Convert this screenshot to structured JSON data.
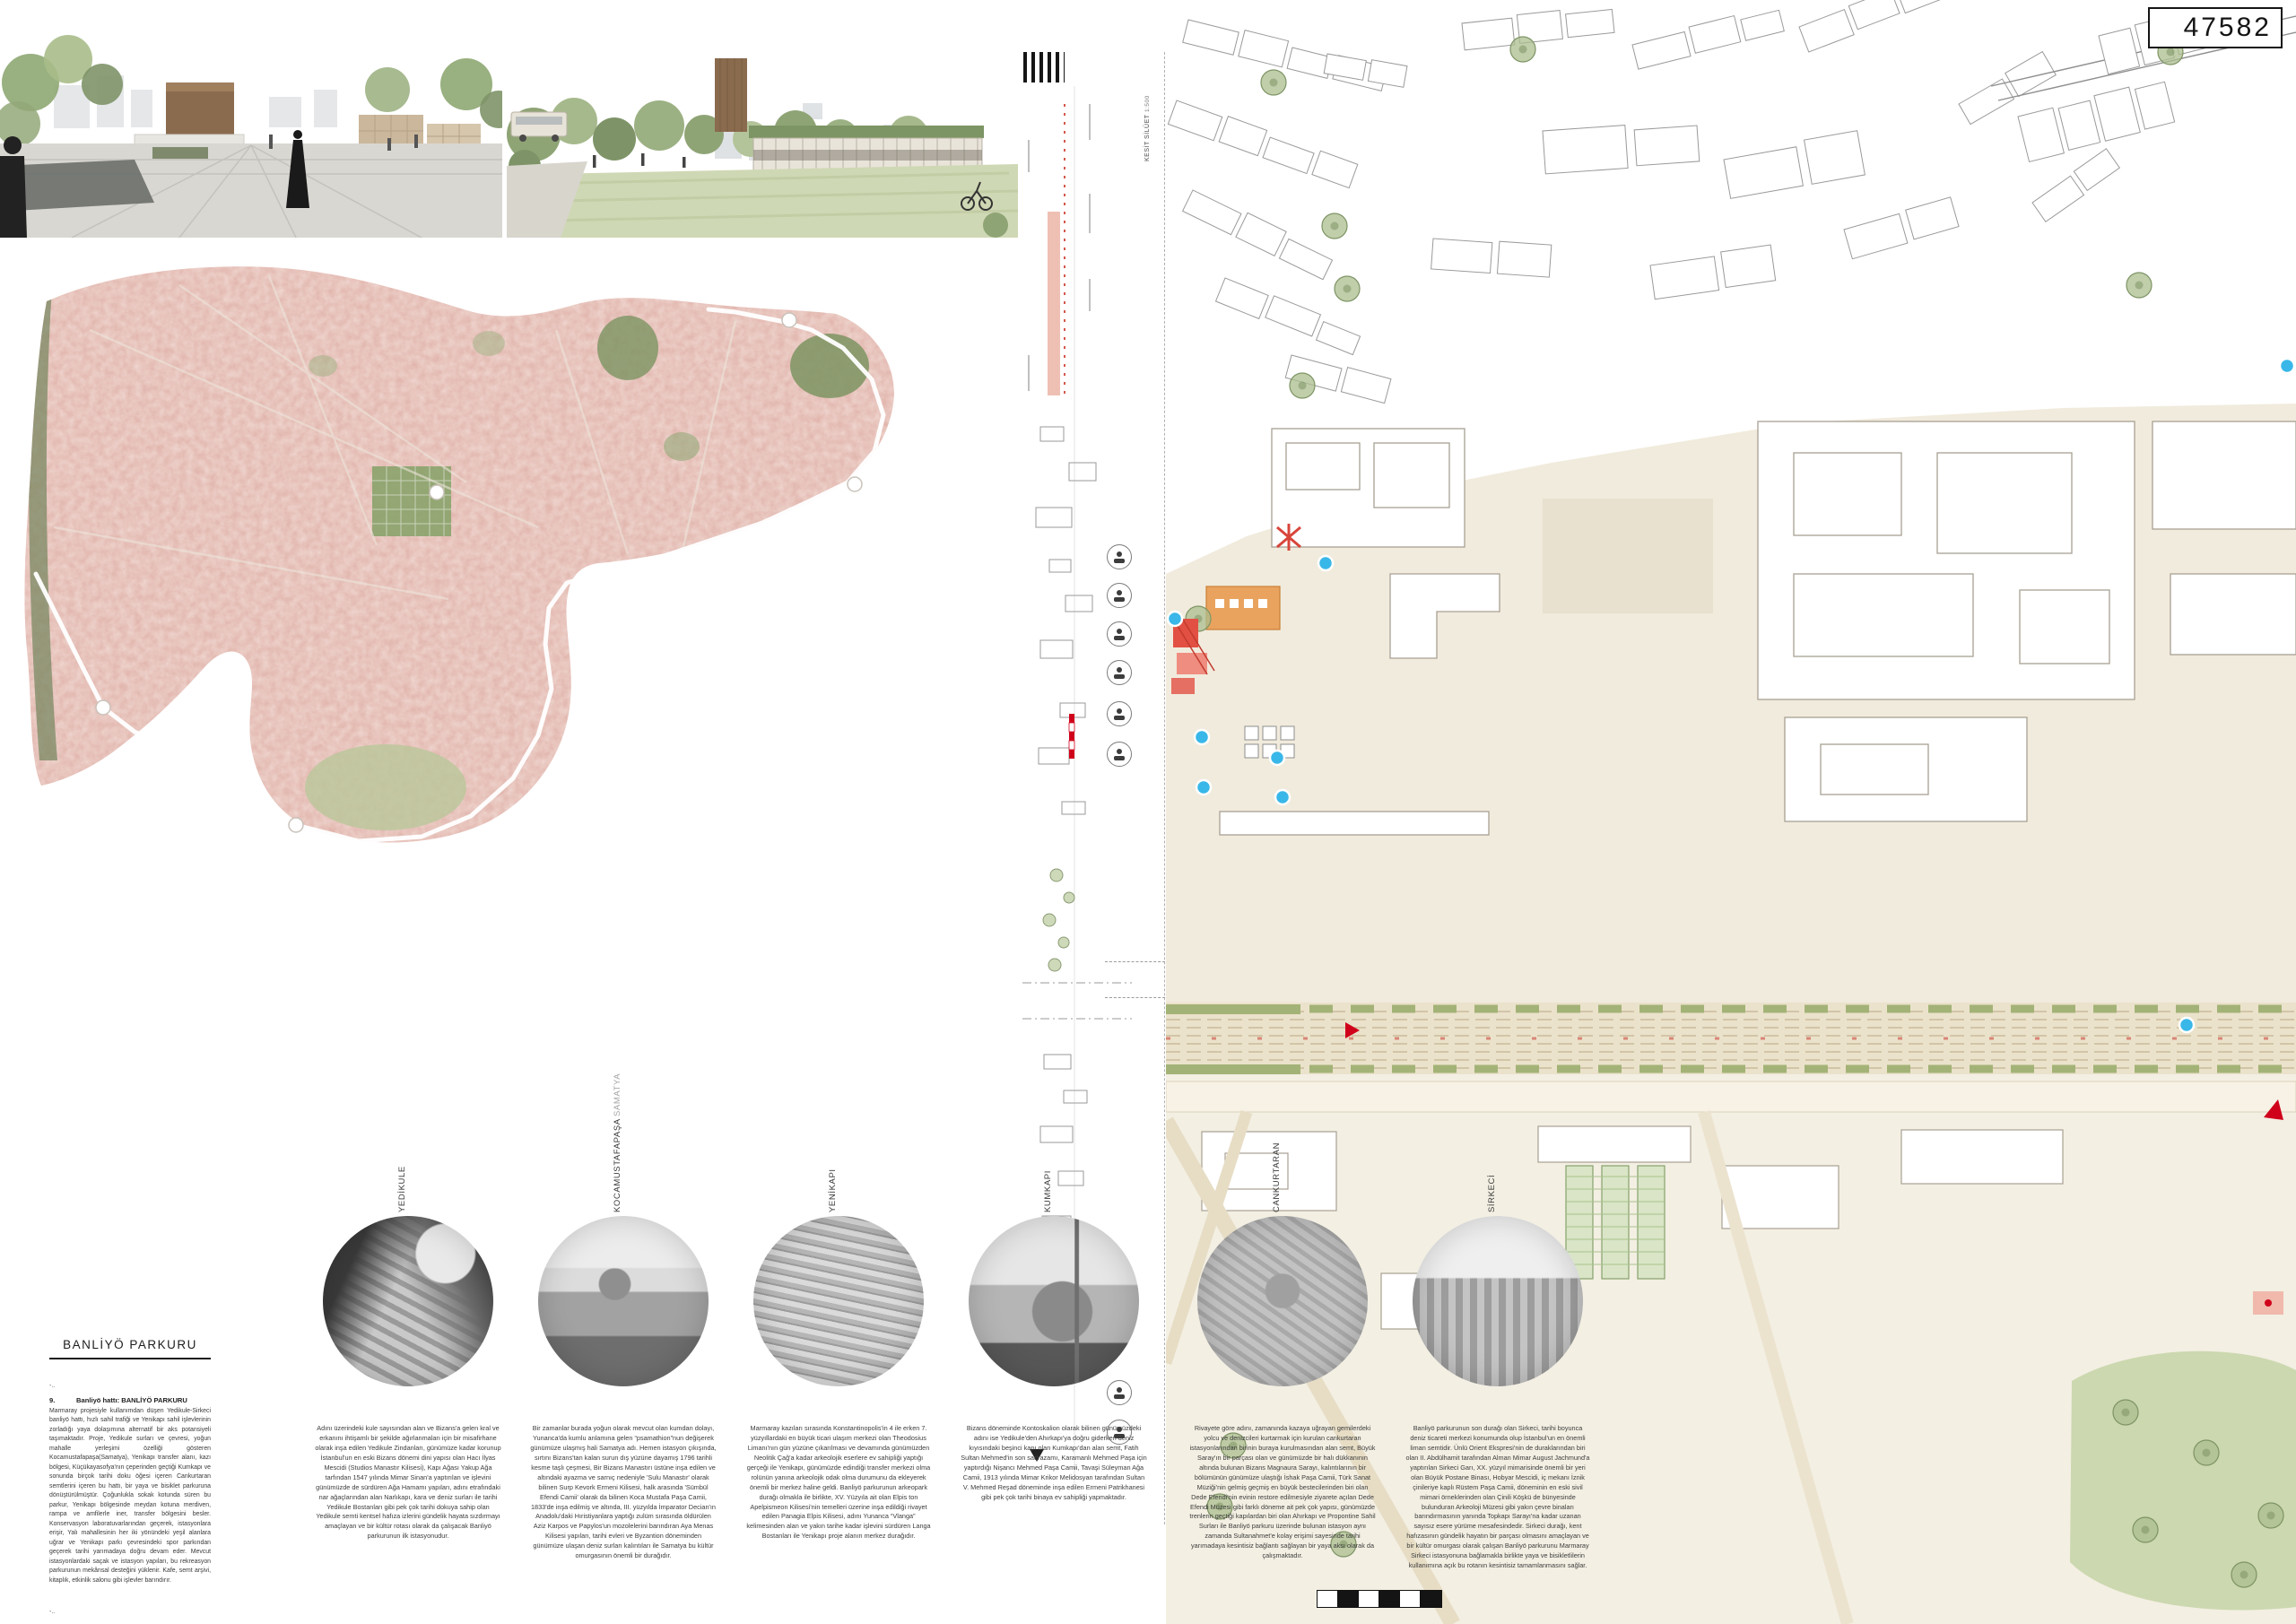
{
  "board": {
    "competition_number": "47582"
  },
  "section_strip": {
    "label": "KESİT SİLÜET",
    "scale": "1:500"
  },
  "title_block": {
    "title": "BANLİYÖ PARKURU",
    "ellipsis_top": "-..",
    "item_number": "9.",
    "heading": "Banliyö hattı: BANLİYÖ PARKURU",
    "body": "Marmaray projesiyle kullanımdan düşen Yedikule-Sirkeci banliyö hattı, hızlı sahil trafiği ve Yenikapı sahil işlevlerinin zorladığı yaya dolaşımına alternatif bir aks potansiyeli taşımaktadır. Proje, Yedikule surları ve çevresi, yoğun mahalle yerleşimi özelliği gösteren Kocamustafapaşa(Samatya), Yenikapı transfer alanı, kazı bölgesi, Küçükayasofya'nın çeperinden geçtiği Kumkapı ve sonunda birçok tarihi doku öğesi içeren Cankurtaran semtlerini içeren bu hattı, bir yaya ve bisiklet parkuruna dönüştürülmüştür. Çoğunlukla sokak kotunda süren bu parkur, Yenikapı bölgesinde meydan kotuna merdiven, rampa ve amfilerle iner, transfer bölgesini besler. Konservasyon laboratuvarlarından geçerek, istasyonlara erişir, Yalı mahallesinin her iki yönündeki yeşil alanlara uğrar ve Yenikapı parkı çevresindeki spor parkından geçerek tarihi yarımadaya doğru devam eder. Mevcut istasyonlardaki saçak ve istasyon yapıları, bu rekreasyon parkurunun mekânsal desteğini yüklenir. Kafe, semt arşivi, kitaplık, etkinlik salonu gibi işlevler barındırır.",
    "ellipsis_bottom": "-.."
  },
  "stations": [
    {
      "name": "YEDİKULE",
      "subtitle": "",
      "description": "Adını üzerindeki kule sayısından alan ve Bizans'a gelen kral ve erkanını ihtişamlı bir şekilde ağırlanmaları için bir misafirhane olarak inşa edilen Yedikule Zindanları, günümüze kadar korunup İstanbul'un en eski Bizans dönemi dini yapısı olan Hacı İlyas Mescidi (Studios Manastır Kilisesi), Kapı Ağası Yakup Ağa tarfından 1547 yılında Mimar Sinan'a yaptırılan ve işlevini günümüzde de sürdüren Ağa Hamamı yapıları, adını etrafındaki nar ağaçlarından alan Narlıkapı, kara ve deniz surları ile tarihi Yedikule Bostanları gibi pek çok tarihi dokuya sahip olan Yedikule semti kentsel hafıza izlerini gündelik hayata sızdırmayı amaçlayan ve bir kültür rotası olarak da çalışacak Banliyö parkurunun ilk istasyonudur."
    },
    {
      "name": "KOCAMUSTAFAPAŞA",
      "subtitle": "SAMATYA",
      "description": "Bir zamanlar burada yoğun olarak mevcut olan kumdan dolayı, Yunanca'da kumlu anlamına gelen “psamathion”nun değişerek günümüze ulaşmış hali Samatya adı. Hemen istasyon çıkışında, sırtını Bizans'tan kalan surun dış yüzüne dayamış 1796 tarihli kesme taşlı çeşmesi, Bir Bizans Manastırı üstüne inşa edilen ve altındaki ayazma ve sarnıç nedeniyle 'Sulu Manastır' olarak bilinen Surp Kevork Ermeni Kilisesi, halk arasında 'Sümbül Efendi Camii' olarak da bilinen Koca Mustafa Paşa Camii, 1833'de inşa edilmiş ve altında, III. yüzyılda İmparator Decian'ın Anadolu'daki Hıristiyanlara yaptığı zulüm sırasında öldürülen Aziz Karpos ve Papylos'un mozolelerini barındıran Aya Menas Kilisesi yapıları, tarihi evleri ve Byzantion döneminden günümüze ulaşan deniz surları kalıntıları ile Samatya bu kültür omurgasının önemli bir durağıdır."
    },
    {
      "name": "YENİKAPI",
      "subtitle": "",
      "description": "Marmaray kazıları sırasında Konstantinopolis'in 4 ile erken 7. yüzyıllardaki en büyük ticari ulaşım merkezi olan Theodosius Limanı'nın gün yüzüne çıkarılması ve devamında günümüzden Neolitik Çağ'a kadar arkeolojik eserlere ev sahipliği yaptığı gerçeği ile Yenikapı, günümüzde edindiği transfer merkezi olma rolünün yanına arkeolojik odak olma durumunu da ekleyerek önemli bir merkez haline geldi. Banliyö parkurunun arkeopark durağı olmakla ile birlikte, XV. Yüzyıla ait olan Elpis ton Apelpismeon Kilisesi'nin temelleri üzerine inşa edildiği rivayet edilen Panagia Elpis Kilisesi, adını Yunanca “Vlanga” kelimesinden alan ve yakın tarihe kadar işlevini sürdüren Langa Bostanları ile Yenikapı proje alanın merkez durağıdır."
    },
    {
      "name": "KUMKAPI",
      "subtitle": "",
      "description": "Bizans döneminde Kontoskalion olarak bilinen günümüzdeki adını ise Yedikule'den Ahırkapı'ya doğru giderken deniz kıyısındaki beşinci kapı olan Kumkapı'dan alan semt, Fatih Sultan Mehmed'in son sadrazamı, Karamanlı Mehmed Paşa için yaptırdığı Nişancı Mehmed Paşa Camii, Tavaşi Süleyman Ağa Camii, 1913 yılında Mimar Krikor Melidosyan tarafından Sultan V. Mehmed Reşad döneminde inşa edilen Ermeni Patrikhanesi gibi pek çok tarihi binaya ev sahipliği yapmaktadır."
    },
    {
      "name": "CANKURTARAN",
      "subtitle": "",
      "description": "Rivayete göre adını, zamanında kazaya uğrayan gemilerdeki yolcu ve denizcileri kurtarmak için kurulan cankurtaran istasyonlarından birinin buraya kurulmasından alan semt, Büyük Saray'ın bir parçası olan ve günümüzde bir halı dükkanının altında bulunan Bizans Magnaura Sarayı, kalıntılarının bir bölümünün günümüze ulaştığı İshak Paşa Camii, Türk Sanat Müziği'nin gelmiş geçmiş en büyük bestecilerinden biri olan Dede Efendi'nin evinin restore edilmesiyle ziyarete açılan Dede Efendi Müzesi gibi farklı döneme ait pek çok yapısı, günümüzde trenlerin geçtiği kapılardan biri olan Ahırkapı ve Propontine Sahil Surları ile Banliyö parkuru üzerinde bulunan istasyon aynı zamanda Sultanahmet'e kolay erişimi sayesinde tarihi yarımadaya kesintisiz bağlantı sağlayan bir yaya aksı olarak da çalışmaktadır."
    },
    {
      "name": "SİRKECİ",
      "subtitle": "",
      "description": "Banliyö parkurunun son durağı olan Sirkeci, tarihi boyunca deniz ticareti merkezi konumunda olup İstanbul'un en önemli liman semtidir. Ünlü Orient Ekspresi'nin de duraklarından biri olan II. Abdülhamit tarafından Alman Mimar August Jachmund'a yaptırılan Sirkeci Garı, XX. yüzyıl mimarisinde önemli bir yeri olan Büyük Postane Binası, Hobyar Mescidi, iç mekanı İznik çinileriye kaplı Rüstem Paşa Camii, döneminin en eski sivil mimari örneklerinden olan Çinili Köşkü de bünyesinde bulunduran Arkeoloji Müzesi gibi yakın çevre binaları barındırmasının yanında Topkapı Sarayı'na kadar uzanan sayısız esere yürüme mesafesindedir. Sirkeci durağı, kent hafızasının gündelik hayatın bir parçası olmasını amaçlayan ve bir kültür omurgası olarak çalışan Banliyö parkurunu Marmaray Sirkeci istasyonuna bağlamakla birlikte yaya ve bisikletlilerin kullanımına açık bu rotanın kesintisiz tamamlanmasını sağlar."
    }
  ]
}
